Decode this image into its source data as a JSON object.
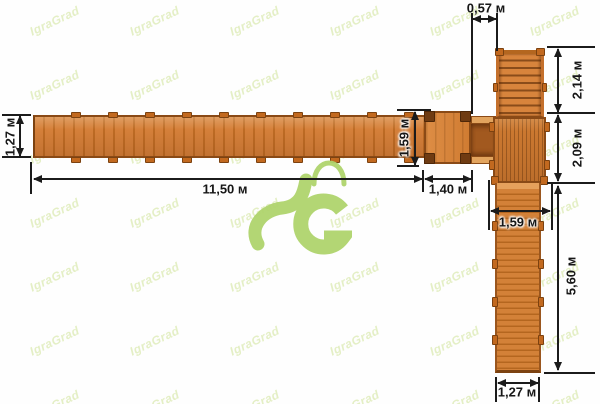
{
  "watermark": {
    "text": "IgraGrad"
  },
  "logo": {
    "name": "igragrad-logo",
    "color": "#b0d46d"
  },
  "colors": {
    "wood_base": "#d5803a",
    "wood_dark": "#bd6b24",
    "wood_edge": "#8a4a16",
    "dimension_ink": "#1b1b1b",
    "logo_green": "#b0d46d",
    "watermark_green": "#e4efc5"
  },
  "dimensions": {
    "left_walkway_width": "1,27 м",
    "walkway_length": "11,50 м",
    "platform_depth": "1,59 м",
    "platform_width": "1,40 м",
    "top_gap": "0,57 м",
    "stairs_length": "2,14 м",
    "deck_length": "2,09 м",
    "lower_walkway_width_top": "1,59 м",
    "lower_walkway_length": "5,60 м",
    "lower_walkway_width_bottom": "1,27 м"
  }
}
